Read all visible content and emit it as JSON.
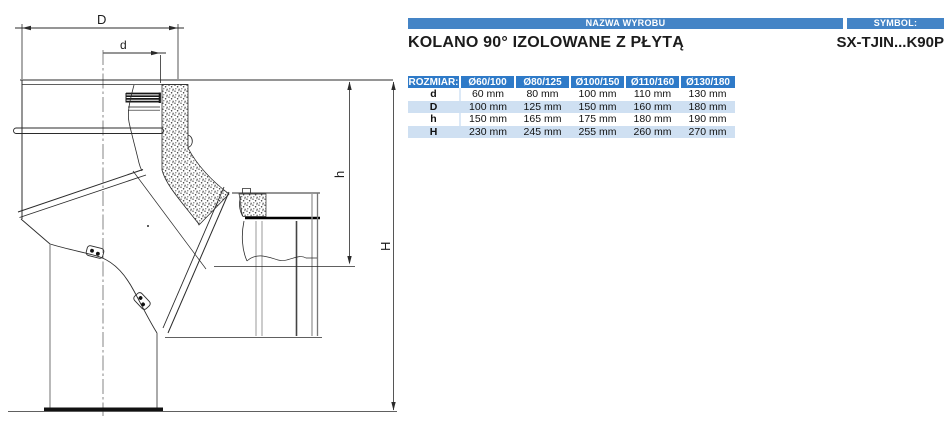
{
  "header": {
    "nazwa_label": "NAZWA WYROBU",
    "symbol_label": "SYMBOL:",
    "product_name": "KOLANO 90° IZOLOWANE Z PŁYTĄ",
    "symbol_value": "SX-TJIN...K90P"
  },
  "drawing": {
    "dim_labels": {
      "D": "D",
      "d": "d",
      "h": "h",
      "H": "H"
    }
  },
  "table": {
    "header": [
      "ROZMIAR:",
      "Ø60/100",
      "Ø80/125",
      "Ø100/150",
      "Ø110/160",
      "Ø130/180"
    ],
    "rows": [
      {
        "name": "d",
        "values": [
          "60 mm",
          "80 mm",
          "100 mm",
          "110 mm",
          "130 mm"
        ]
      },
      {
        "name": "D",
        "values": [
          "100 mm",
          "125 mm",
          "150 mm",
          "160 mm",
          "180 mm"
        ]
      },
      {
        "name": "h",
        "values": [
          "150 mm",
          "165 mm",
          "175 mm",
          "180 mm",
          "190 mm"
        ]
      },
      {
        "name": "H",
        "values": [
          "230 mm",
          "245 mm",
          "255 mm",
          "260 mm",
          "270 mm"
        ]
      }
    ]
  },
  "colors": {
    "header_bar_blue": "#4484c6",
    "table_header_blue": "#2e7ac8",
    "table_alt_row_blue": "#cfe0f2",
    "line_ink": "#2b2b2b"
  }
}
